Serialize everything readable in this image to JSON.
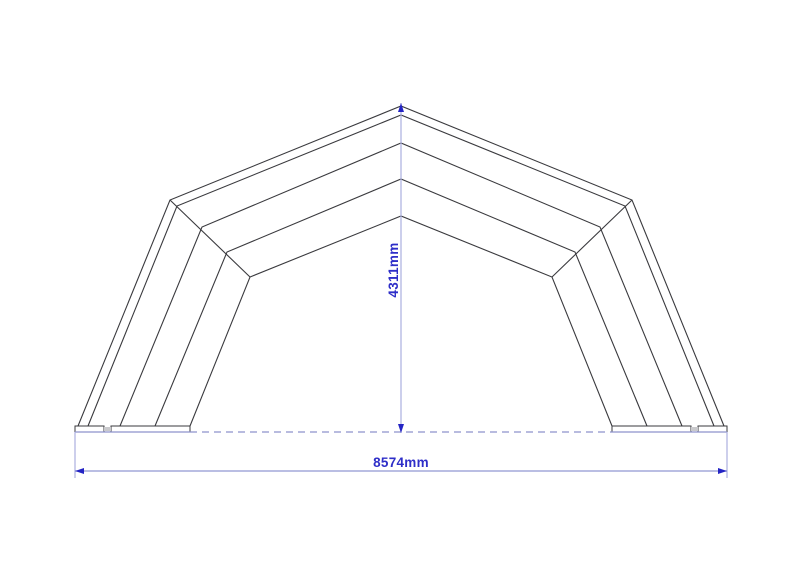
{
  "title": "tent-frame-section-drawing",
  "colors": {
    "background": "#ffffff",
    "structure_line": "#3a3a3e",
    "ground_line": "#8d92cc",
    "dimension_line_light": "#abafe0",
    "dimension_line": "#9096d2",
    "arrow": "#2424c4",
    "dimension_text": "#2e2ec8",
    "plate_gap_fill": "#c9c9cc"
  },
  "structure": {
    "center_x": 401,
    "ground_y": 426,
    "shells": [
      {
        "foot_x": 78,
        "knee": [
          170,
          200
        ],
        "apex_y": 106
      },
      {
        "foot_x": 88,
        "knee": [
          177,
          206
        ],
        "apex_y": 115
      },
      {
        "foot_x": 120,
        "knee": [
          202,
          227
        ],
        "apex_y": 143
      },
      {
        "foot_x": 155,
        "knee": [
          227,
          252
        ],
        "apex_y": 179
      },
      {
        "foot_x": 190,
        "knee": [
          250,
          277
        ],
        "apex_y": 216
      }
    ],
    "knee_seams": [
      [
        [
          170,
          200
        ],
        [
          250,
          277
        ]
      ],
      [
        [
          632,
          200
        ],
        [
          552,
          277
        ]
      ]
    ],
    "baseplates": [
      {
        "x": 75,
        "w": 29
      },
      {
        "x": 111,
        "w": 79
      },
      {
        "x": 612,
        "w": 79
      },
      {
        "x": 698,
        "w": 29
      }
    ],
    "plate_h": 6,
    "plate_gaps": [
      {
        "x": 104,
        "w": 7
      },
      {
        "x": 691,
        "w": 7
      }
    ]
  },
  "ground_line": {
    "y": 432,
    "solid_segments": [
      [
        75,
        190
      ],
      [
        612,
        727
      ]
    ],
    "dashed_segments": [
      [
        190,
        612
      ]
    ],
    "dash_pattern": "7,5"
  },
  "dimensions": {
    "height": {
      "label": "4311mm",
      "x": 401,
      "y_top": 103,
      "y_bottom": 433,
      "label_x": 398,
      "label_y": 270
    },
    "width": {
      "label": "8574mm",
      "y": 471,
      "x_left": 75,
      "x_right": 727,
      "ext_y_top": 432,
      "ext_y_bottom": 478,
      "label_x": 401,
      "label_y": 467
    }
  }
}
